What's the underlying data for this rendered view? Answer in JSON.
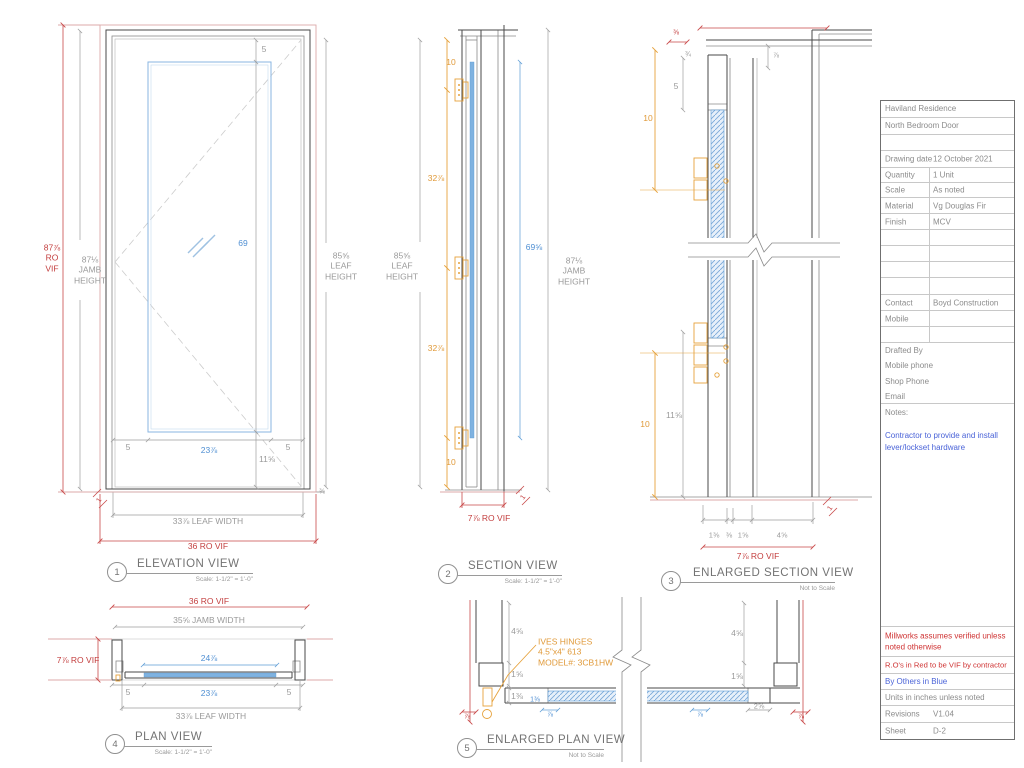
{
  "drawing_labels": [
    {
      "n": "elev-ro-height-dim",
      "t": "87⅞\nRO\nVIF",
      "x": 52,
      "y": 258,
      "c": "red"
    },
    {
      "n": "elev-jamb-height-dim",
      "t": "87⅛\nJAMB\nHEIGHT",
      "x": 90,
      "y": 270,
      "c": "gray"
    },
    {
      "n": "elev-leaf-height-dim",
      "t": "85⅝\nLEAF\nHEIGHT",
      "x": 341,
      "y": 266,
      "c": "gray"
    },
    {
      "n": "elev-top-rail-dim",
      "t": "5",
      "x": 264,
      "y": 49,
      "c": "gray"
    },
    {
      "n": "elev-glass-height-dim",
      "t": "69",
      "x": 243,
      "y": 243,
      "c": "blue"
    },
    {
      "n": "elev-bottom-rail-dim",
      "t": "11⅝",
      "x": 267,
      "y": 459,
      "c": "gray"
    },
    {
      "n": "elev-left-stile-dim",
      "t": "5",
      "x": 128,
      "y": 447,
      "c": "gray"
    },
    {
      "n": "elev-lite-width-dim",
      "t": "23⅞",
      "x": 209,
      "y": 450,
      "c": "blue"
    },
    {
      "n": "elev-right-stile-dim",
      "t": "5",
      "x": 288,
      "y": 447,
      "c": "gray"
    },
    {
      "n": "elev-leaf-width-dim",
      "t": "33⅞ LEAF WIDTH",
      "x": 208,
      "y": 521,
      "c": "gray"
    },
    {
      "n": "elev-ro-width-dim",
      "t": "36 RO VIF",
      "x": 208,
      "y": 546,
      "c": "red"
    },
    {
      "n": "elev-gap-dim-left",
      "t": "1",
      "x": 100,
      "y": 501,
      "c": "red",
      "s": 7,
      "r": -55
    },
    {
      "n": "elev-gap-dim-right",
      "t": "⅜",
      "x": 322,
      "y": 493,
      "c": "gray",
      "s": 7
    },
    {
      "n": "sect-top-hinge-dim",
      "t": "10",
      "x": 451,
      "y": 62,
      "c": "orange"
    },
    {
      "n": "sect-hinge-spacing-dim-1",
      "t": "32⅞",
      "x": 436,
      "y": 178,
      "c": "orange"
    },
    {
      "n": "sect-hinge-spacing-dim-2",
      "t": "32⅞",
      "x": 436,
      "y": 348,
      "c": "orange"
    },
    {
      "n": "sect-bottom-hinge-dim",
      "t": "10",
      "x": 451,
      "y": 462,
      "c": "orange"
    },
    {
      "n": "sect-glass-height-dim",
      "t": "69⅝",
      "x": 534,
      "y": 247,
      "c": "blue"
    },
    {
      "n": "sect-leaf-height-dim",
      "t": "85⅝\nLEAF\nHEIGHT",
      "x": 402,
      "y": 266,
      "c": "gray"
    },
    {
      "n": "sect-jamb-height-dim",
      "t": "87⅛\nJAMB\nHEIGHT",
      "x": 574,
      "y": 271,
      "c": "gray"
    },
    {
      "n": "sect-ro-depth-dim",
      "t": "7⅞ RO VIF",
      "x": 489,
      "y": 518,
      "c": "red"
    },
    {
      "n": "sect-gap-dim",
      "t": "1",
      "x": 524,
      "y": 498,
      "c": "red",
      "s": 7,
      "r": -55
    },
    {
      "n": "esect-shim-dim-top",
      "t": "⅜",
      "x": 676,
      "y": 34,
      "c": "red",
      "s": 7
    },
    {
      "n": "esect-head-shim-dim",
      "t": "¾",
      "x": 688,
      "y": 56,
      "c": "gray",
      "s": 7
    },
    {
      "n": "esect-head-gap-dim",
      "t": "⅞",
      "x": 776,
      "y": 57,
      "c": "gray",
      "s": 7
    },
    {
      "n": "esect-top-rail-dim",
      "t": "5",
      "x": 676,
      "y": 86,
      "c": "gray"
    },
    {
      "n": "esect-hinge-top-dim",
      "t": "10",
      "x": 648,
      "y": 118,
      "c": "orange"
    },
    {
      "n": "esect-hinge-bottom-dim",
      "t": "10",
      "x": 645,
      "y": 424,
      "c": "orange"
    },
    {
      "n": "esect-bottom-rail-dim",
      "t": "11⅝",
      "x": 674,
      "y": 415,
      "c": "gray"
    },
    {
      "n": "esect-leaf-thickness-dim",
      "t": "1⅜",
      "x": 714,
      "y": 535,
      "c": "gray",
      "s": 7.5
    },
    {
      "n": "esect-stop-dim",
      "t": "⅜",
      "x": 729,
      "y": 535,
      "c": "gray",
      "s": 7.5
    },
    {
      "n": "esect-jamb-depth-dim",
      "t": "1⅝",
      "x": 743,
      "y": 535,
      "c": "gray",
      "s": 7.5
    },
    {
      "n": "esect-wall-depth-dim",
      "t": "4⅝",
      "x": 782,
      "y": 535,
      "c": "gray",
      "s": 7.5
    },
    {
      "n": "esect-ro-depth-dim",
      "t": "7⅞ RO VIF",
      "x": 758,
      "y": 556,
      "c": "red"
    },
    {
      "n": "esect-gap-dim",
      "t": "1",
      "x": 831,
      "y": 509,
      "c": "red",
      "s": 7,
      "r": -55
    },
    {
      "n": "eplan-hinge-note",
      "t": "IVES HINGES\n4.5\"x4\" 613\nMODEL#: 3CB1HW",
      "x": 538,
      "y": 652,
      "c": "orange",
      "a": "left"
    },
    {
      "n": "eplan-wall-depth-dim-left",
      "t": "4⅝",
      "x": 517,
      "y": 631,
      "c": "gray"
    },
    {
      "n": "eplan-jamb-dim-left",
      "t": "1⅝",
      "x": 517,
      "y": 674,
      "c": "gray"
    },
    {
      "n": "eplan-leaf-thickness-dim-left",
      "t": "1⅜",
      "x": 517,
      "y": 696,
      "c": "gray"
    },
    {
      "n": "eplan-hinge-stile-dim",
      "t": "1⅜",
      "x": 535,
      "y": 701,
      "c": "blue",
      "s": 7
    },
    {
      "n": "eplan-glass-inset-dim-left",
      "t": "⅞",
      "x": 550,
      "y": 716,
      "c": "blue",
      "s": 7
    },
    {
      "n": "eplan-glass-inset-dim-right",
      "t": "⅞",
      "x": 700,
      "y": 716,
      "c": "blue",
      "s": 7
    },
    {
      "n": "eplan-wall-depth-dim-right",
      "t": "4⅝",
      "x": 737,
      "y": 633,
      "c": "gray"
    },
    {
      "n": "eplan-jamb-dim-right",
      "t": "1⅝",
      "x": 737,
      "y": 676,
      "c": "gray"
    },
    {
      "n": "eplan-lock-stile-dim",
      "t": "2⅝",
      "x": 759,
      "y": 706,
      "c": "gray",
      "s": 7.5
    },
    {
      "n": "eplan-gap-dim-left",
      "t": "⅞",
      "x": 467,
      "y": 718,
      "c": "red",
      "s": 7
    },
    {
      "n": "eplan-gap-dim-right",
      "t": "⅞",
      "x": 801,
      "y": 718,
      "c": "red",
      "s": 7
    },
    {
      "n": "plan-ro-width-dim",
      "t": "36 RO VIF",
      "x": 209,
      "y": 601,
      "c": "red"
    },
    {
      "n": "plan-jamb-width-dim",
      "t": "35⅝ JAMB WIDTH",
      "x": 209,
      "y": 620,
      "c": "gray"
    },
    {
      "n": "plan-ro-depth-dim",
      "t": "7⅞ RO VIF",
      "x": 78,
      "y": 660,
      "c": "red"
    },
    {
      "n": "plan-glass-stop-width-dim",
      "t": "24⅞",
      "x": 209,
      "y": 658,
      "c": "blue"
    },
    {
      "n": "plan-left-stile-dim",
      "t": "5",
      "x": 128,
      "y": 692,
      "c": "gray"
    },
    {
      "n": "plan-lite-width-dim",
      "t": "23⅞",
      "x": 209,
      "y": 693,
      "c": "blue"
    },
    {
      "n": "plan-right-stile-dim",
      "t": "5",
      "x": 289,
      "y": 692,
      "c": "gray"
    },
    {
      "n": "plan-leaf-width-dim",
      "t": "33⅞ LEAF WIDTH",
      "x": 211,
      "y": 716,
      "c": "gray"
    }
  ],
  "view_titles": [
    {
      "num": "1",
      "title": "ELEVATION VIEW",
      "scale": "Scale: 1-1/2\" = 1'-0\"",
      "cx": 116,
      "cy": 571,
      "tx": 137,
      "ty": 558,
      "uend": 253
    },
    {
      "num": "2",
      "title": "SECTION VIEW",
      "scale": "Scale: 1-1/2\" = 1'-0\"",
      "cx": 447,
      "cy": 573,
      "tx": 468,
      "ty": 560,
      "uend": 562
    },
    {
      "num": "3",
      "title": "ENLARGED SECTION VIEW",
      "scale": "Not to Scale",
      "cx": 670,
      "cy": 580,
      "tx": 693,
      "ty": 567,
      "uend": 835
    },
    {
      "num": "4",
      "title": "PLAN VIEW",
      "scale": "Scale: 1-1/2\" = 1'-0\"",
      "cx": 114,
      "cy": 743,
      "tx": 135,
      "ty": 731,
      "uend": 212
    },
    {
      "num": "5",
      "title": "ENLARGED PLAN VIEW",
      "scale": "Not to Scale",
      "cx": 466,
      "cy": 747,
      "tx": 487,
      "ty": 734,
      "uend": 604
    }
  ],
  "title_block": {
    "x": 880,
    "y": 100,
    "w": 133,
    "h": 638,
    "sections": [
      {
        "type": "cell",
        "label": "Haviland Residence",
        "top": 0,
        "h": 16
      },
      {
        "type": "cell",
        "label": "North Bedroom Door",
        "top": 16,
        "h": 17
      },
      {
        "type": "cell",
        "label": "",
        "top": 33,
        "h": 16
      },
      {
        "type": "two",
        "label": "Drawing date",
        "value": "12 October 2021",
        "top": 49,
        "h": 17,
        "nodiv": true
      },
      {
        "type": "two",
        "label": "Quantity",
        "value": "1 Unit",
        "top": 66,
        "h": 15
      },
      {
        "type": "two",
        "label": "Scale",
        "value": "As noted",
        "top": 81,
        "h": 15
      },
      {
        "type": "two",
        "label": "Material",
        "value": "Vg Douglas Fir",
        "top": 96,
        "h": 16
      },
      {
        "type": "two",
        "label": "Finish",
        "value": "MCV",
        "top": 112,
        "h": 16
      },
      {
        "type": "two",
        "label": "",
        "value": "",
        "top": 128,
        "h": 16
      },
      {
        "type": "two",
        "label": "",
        "value": "",
        "top": 144,
        "h": 16
      },
      {
        "type": "two",
        "label": "",
        "value": "",
        "top": 160,
        "h": 16
      },
      {
        "type": "two",
        "label": "",
        "value": "",
        "top": 176,
        "h": 17
      },
      {
        "type": "two",
        "label": "Contact",
        "value": "Boyd Construction",
        "top": 193,
        "h": 16
      },
      {
        "type": "two",
        "label": "Mobile",
        "value": "",
        "top": 209,
        "h": 16
      },
      {
        "type": "two",
        "label": "",
        "value": "",
        "top": 225,
        "h": 16
      },
      {
        "type": "group",
        "lines": [
          "Drafted By",
          "Mobile phone",
          "Shop Phone",
          "Email"
        ],
        "top": 241,
        "h": 61
      },
      {
        "type": "notes",
        "label": "Notes:",
        "note": "Contractor to provide and install lever/lockset hardware",
        "top": 302,
        "h": 223
      },
      {
        "type": "cell",
        "label": "Millworks assumes verified unless noted otherwise",
        "top": 525,
        "h": 30,
        "cls": "tred"
      },
      {
        "type": "cell",
        "label": "R.O's in Red to be VIF by contractor",
        "top": 555,
        "h": 17,
        "cls": "tred",
        "fs": 7.6
      },
      {
        "type": "cell",
        "label": "By Others in Blue",
        "top": 572,
        "h": 16,
        "cls": "tblue"
      },
      {
        "type": "cell",
        "label": "Units in inches unless noted",
        "top": 588,
        "h": 16
      },
      {
        "type": "two",
        "label": "Revisions",
        "value": "V1.04",
        "top": 604,
        "h": 17,
        "nodiv": true
      },
      {
        "type": "two",
        "label": "Sheet",
        "value": "D-2",
        "top": 621,
        "h": 17,
        "nodiv": true
      }
    ]
  },
  "colors": {
    "dim_red": "#c84848",
    "dim_blue": "#5b9bd5",
    "dim_orange": "#e6a23c",
    "dim_gray": "#9e9e9e",
    "note_blue": "#4a63d8",
    "note_red": "#cf3434",
    "glass_fill": "#7fb2e0"
  }
}
